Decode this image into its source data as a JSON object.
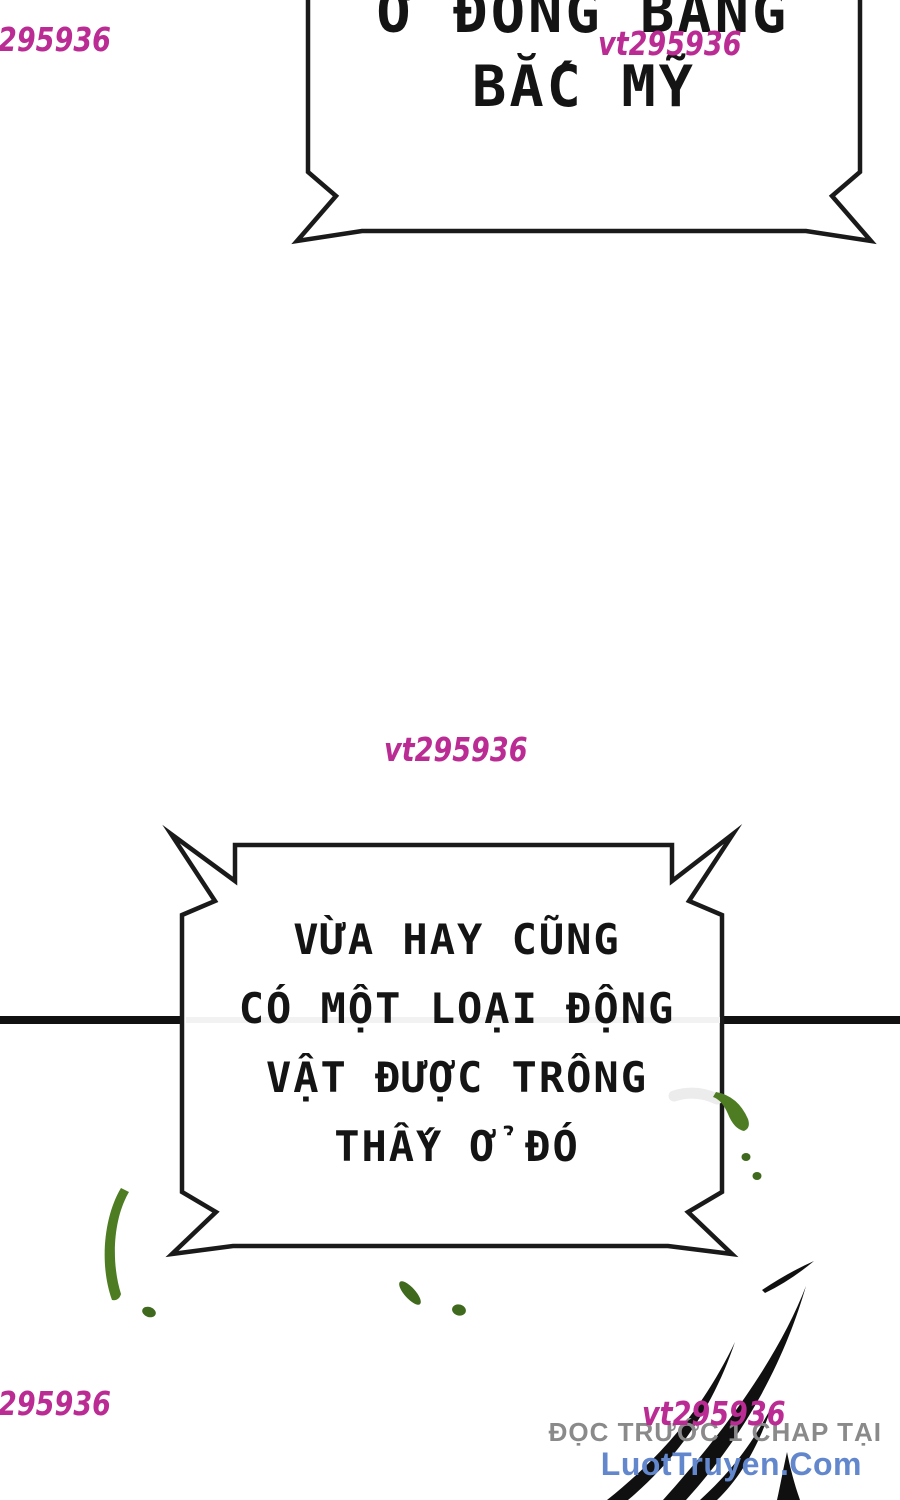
{
  "page": {
    "background": "#ffffff"
  },
  "bubbles": {
    "top": {
      "lines": [
        "Ở ĐỒNG BẰNG",
        "BẮC MỸ"
      ]
    },
    "main": {
      "lines": [
        "VỪA HAY CŨNG",
        "CÓ MỘT LOẠI ĐỘNG",
        "VẬT ĐƯỢC TRÔNG",
        "THẤY Ở ĐÓ"
      ]
    }
  },
  "watermark": {
    "full_text": "vt295936",
    "partial_text": "295936",
    "color": "#bb2b94"
  },
  "footer": {
    "promo_text": "ĐỌC TRƯỚC 1 CHAP TẠI",
    "site_name": "LuotTruyen.Com",
    "promo_color": "#8a8a8a",
    "site_color": "#6287cd"
  },
  "artwork": {
    "ink_color": "#1a1a1a",
    "claw_color": "#101010",
    "divider_color": "#111111",
    "green_color": "#4e7c23",
    "green_dark": "#3f691c",
    "faint_gray": "#ececec"
  }
}
